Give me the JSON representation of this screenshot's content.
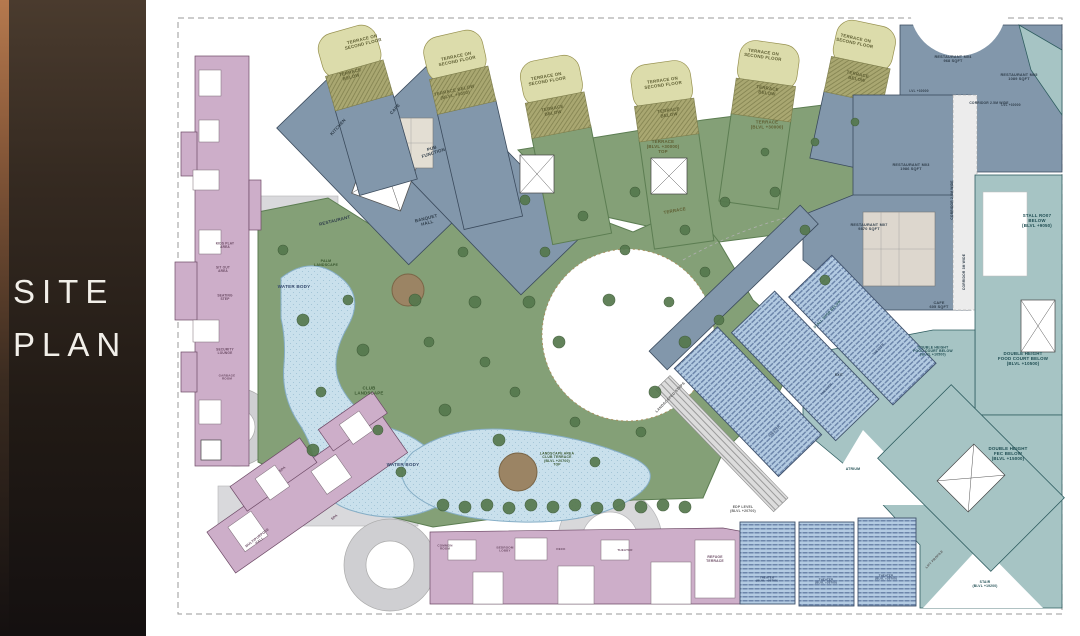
{
  "sidebar": {
    "title_line1": "SITE",
    "title_line2": "PLAN"
  },
  "zone_colors": {
    "residential_pink": "#cdaec9",
    "fnb_slate": "#8297ab",
    "retail_teal": "#a6c4c4",
    "terrace_olive": "#a9a771",
    "terrace_pale": "#dcdcab",
    "landscape_green": "#84a077",
    "water": "#c9e0ec",
    "cinema_seating": "#b3cbe2"
  },
  "plan": {
    "labels": [
      {
        "text": "TERRACE ON\nSECOND FLOOR",
        "x": 200,
        "y": 43,
        "r": -14,
        "c": "olive"
      },
      {
        "text": "TERRACE\nBELOW",
        "x": 188,
        "y": 76,
        "r": -14,
        "c": "olive"
      },
      {
        "text": "TERRACE ON\nSECOND FLOOR",
        "x": 294,
        "y": 60,
        "r": -12,
        "c": "olive"
      },
      {
        "text": "TERRACE BELOW\n(BLVL +9050)",
        "x": 292,
        "y": 94,
        "r": -12,
        "c": "olive"
      },
      {
        "text": "TERRACE ON\nSECOND FLOOR",
        "x": 384,
        "y": 80,
        "r": -10,
        "c": "olive"
      },
      {
        "text": "TERRACE\nBELOW",
        "x": 390,
        "y": 112,
        "r": -10,
        "c": "olive"
      },
      {
        "text": "TERRACE ON\nSECOND FLOOR",
        "x": 500,
        "y": 84,
        "r": -8,
        "c": "olive"
      },
      {
        "text": "TERRACE\nBELOW",
        "x": 506,
        "y": 114,
        "r": -8,
        "c": "olive"
      },
      {
        "text": "TERRACE ON\nSECOND FLOOR",
        "x": 600,
        "y": 56,
        "r": 8,
        "c": "olive"
      },
      {
        "text": "TERRACE\nBELOW",
        "x": 604,
        "y": 92,
        "r": 8,
        "c": "olive"
      },
      {
        "text": "TERRACE ON\nSECOND FLOOR",
        "x": 692,
        "y": 42,
        "r": 12,
        "c": "olive"
      },
      {
        "text": "TERRACE\nBELOW",
        "x": 694,
        "y": 78,
        "r": 12,
        "c": "olive"
      },
      {
        "text": "TERRACE\n(BLVL +30000)",
        "x": 604,
        "y": 126,
        "c": "olive"
      },
      {
        "text": "TERRACE\n(BLVL +30000)\nTOP",
        "x": 500,
        "y": 148,
        "c": "olive"
      },
      {
        "text": "TERRACE",
        "x": 512,
        "y": 212,
        "r": -10,
        "c": "olive"
      },
      {
        "text": "PALM\nLANDSCAPE",
        "x": 163,
        "y": 264,
        "c": "green",
        "s": 3.6
      },
      {
        "text": "CLUB\nLANDSCAPE",
        "x": 206,
        "y": 392,
        "c": "green"
      },
      {
        "text": "LANDSCAPE AREA\nCLUB TERRACE\n(BLVL +20700)\nTOP",
        "x": 394,
        "y": 460,
        "c": "green",
        "s": 3.4
      },
      {
        "text": "LANDSCAPED STEPS",
        "x": 508,
        "y": 398,
        "r": -46,
        "c": "gray",
        "s": 3.6
      },
      {
        "text": "WATER BODY",
        "x": 131,
        "y": 288,
        "c": "blue",
        "s": 4.6
      },
      {
        "text": "WATER BODY",
        "x": 240,
        "y": 466,
        "c": "blue",
        "s": 4.6
      },
      {
        "text": "KITCHEN",
        "x": 176,
        "y": 128,
        "r": -48,
        "c": "slate"
      },
      {
        "text": "CAFE",
        "x": 233,
        "y": 110,
        "r": -48,
        "c": "slate"
      },
      {
        "text": "PUB\nFUNCTION",
        "x": 270,
        "y": 152,
        "r": -18,
        "c": "slate"
      },
      {
        "text": "RESTAURANT",
        "x": 172,
        "y": 222,
        "r": -14,
        "c": "slate"
      },
      {
        "text": "BANQUET\nHALL",
        "x": 264,
        "y": 222,
        "r": -14,
        "c": "slate"
      },
      {
        "text": "RESTAURANT M04\n968 SQFT",
        "x": 790,
        "y": 60,
        "c": "slate",
        "s": 3.8
      },
      {
        "text": "RESTAURANT M05\n1089 SQFT",
        "x": 856,
        "y": 78,
        "c": "slate",
        "s": 3.8
      },
      {
        "text": "RESTAURANT M03\n1986 SQFT",
        "x": 748,
        "y": 168,
        "c": "slate",
        "s": 3.8
      },
      {
        "text": "RESTAURANT M07\n9870 SQFT",
        "x": 706,
        "y": 228,
        "c": "slate",
        "s": 3.8
      },
      {
        "text": "CAFE\n605 SQFT",
        "x": 776,
        "y": 306,
        "c": "slate",
        "s": 3.8
      },
      {
        "text": "CORRIDOR 2.5M WIDE",
        "x": 826,
        "y": 104,
        "c": "slate",
        "s": 3.3
      },
      {
        "text": "CORRIDOR 2.5M WIDE",
        "x": 790,
        "y": 200,
        "r": -90,
        "c": "slate",
        "s": 3.3
      },
      {
        "text": "CORRIDOR 3M WIDE",
        "x": 802,
        "y": 272,
        "r": -90,
        "c": "slate",
        "s": 3.3
      },
      {
        "text": "LVL +30000",
        "x": 756,
        "y": 92,
        "c": "slate",
        "s": 3.2
      },
      {
        "text": "LVL +30000",
        "x": 848,
        "y": 106,
        "c": "slate",
        "s": 3.2
      },
      {
        "text": "STALL RO07\nBELOW\n(BLVL +9050)",
        "x": 874,
        "y": 222,
        "c": "teal"
      },
      {
        "text": "DOUBLE HEIGHT\nFOOD COURT BELOW\n(BLVL +10500)",
        "x": 860,
        "y": 360,
        "c": "teal"
      },
      {
        "text": "DOUBLE HEIGHT\nFOOD COURT BELOW\n(BLVL +10500)",
        "x": 770,
        "y": 352,
        "c": "teal",
        "s": 3.4
      },
      {
        "text": "DOUBLE HEIGHT\nFEC BELOW\n(BLVL +15000)",
        "x": 845,
        "y": 455,
        "c": "teal"
      },
      {
        "text": "ATRIUM",
        "x": 690,
        "y": 470,
        "c": "teal",
        "s": 3.5
      },
      {
        "text": "EXIT",
        "x": 676,
        "y": 376,
        "c": "slate",
        "s": 3.4
      },
      {
        "text": "STALL SHOP BELOW",
        "x": 665,
        "y": 315,
        "r": -46,
        "c": "teal",
        "s": 3.4
      },
      {
        "text": "STAIR\n(BLVL +19200)",
        "x": 822,
        "y": 585,
        "c": "teal",
        "s": 3.3
      },
      {
        "text": "LIFT PROFILE",
        "x": 772,
        "y": 560,
        "r": -46,
        "c": "gray",
        "s": 3.2
      },
      {
        "text": "EDP LEVEL\n(BLVL +20700)",
        "x": 580,
        "y": 510,
        "c": "gray",
        "s": 3.4
      },
      {
        "text": "KIDS PLAY\nAREA",
        "x": 62,
        "y": 246,
        "c": "pink",
        "s": 3.2
      },
      {
        "text": "SIT OUT\nAREA",
        "x": 60,
        "y": 270,
        "c": "pink",
        "s": 3.2
      },
      {
        "text": "SEATING\nSTEP",
        "x": 62,
        "y": 298,
        "c": "pink",
        "s": 3.2
      },
      {
        "text": "SECURITY\nLOUNGE",
        "x": 62,
        "y": 352,
        "c": "pink",
        "s": 3.2
      },
      {
        "text": "GARBAGE\nROOM",
        "x": 64,
        "y": 378,
        "c": "pink",
        "s": 3.0
      },
      {
        "text": "SPA",
        "x": 120,
        "y": 470,
        "r": -38,
        "c": "pink",
        "s": 3.4
      },
      {
        "text": "MULTIPURPOSE\nHALL",
        "x": 96,
        "y": 540,
        "r": -38,
        "c": "pink",
        "s": 3.4
      },
      {
        "text": "SPA",
        "x": 172,
        "y": 518,
        "r": -38,
        "c": "pink",
        "s": 3.4
      },
      {
        "text": "COMMON\nROOM",
        "x": 282,
        "y": 548,
        "c": "pink",
        "s": 3.0
      },
      {
        "text": "BEDROOM\nLOBBY",
        "x": 342,
        "y": 550,
        "c": "pink",
        "s": 3.0
      },
      {
        "text": "DECK",
        "x": 398,
        "y": 550,
        "c": "pink",
        "s": 3.0
      },
      {
        "text": "THEATER",
        "x": 462,
        "y": 551,
        "c": "pink",
        "s": 3.0
      },
      {
        "text": "REFUGE\nTERRACE",
        "x": 552,
        "y": 560,
        "c": "pink",
        "s": 3.4
      },
      {
        "text": "THEATER\n(BLVL +20700)",
        "x": 604,
        "y": 580,
        "c": "blue",
        "s": 2.8
      },
      {
        "text": "THEATER\n(BLVL +20700)",
        "x": 663,
        "y": 582,
        "c": "blue",
        "s": 2.8
      },
      {
        "text": "THEATER\n(BLVL +20700)",
        "x": 723,
        "y": 578,
        "c": "blue",
        "s": 2.8
      },
      {
        "text": "THEATER",
        "x": 612,
        "y": 432,
        "r": -46,
        "c": "blue",
        "s": 3.0
      },
      {
        "text": "THEATER",
        "x": 664,
        "y": 390,
        "r": -46,
        "c": "blue",
        "s": 3.0
      },
      {
        "text": "THEATER",
        "x": 716,
        "y": 350,
        "r": -46,
        "c": "blue",
        "s": 3.0
      }
    ]
  }
}
